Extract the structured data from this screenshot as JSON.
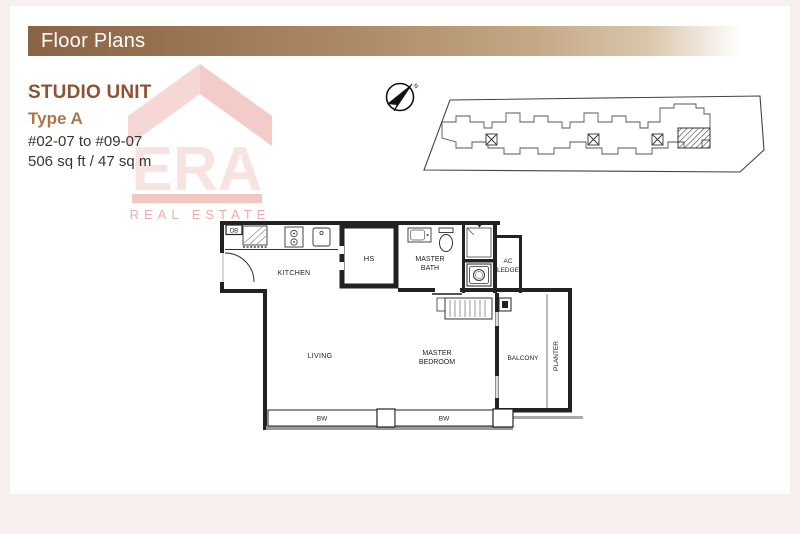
{
  "header": {
    "title": "Floor Plans"
  },
  "unit": {
    "name": "STUDIO UNIT",
    "type": "Type A",
    "range": "#02-07 to #09-07",
    "area": "506 sq ft / 47 sq m"
  },
  "watermark": {
    "brand": "ERA",
    "tagline": "REAL ESTATE"
  },
  "compass": {
    "north": "N"
  },
  "plan": {
    "labels": {
      "db": "DB",
      "kitchen": "KITCHEN",
      "hs": "HS",
      "master": "MASTER",
      "bath": "BATH",
      "ac": "AC",
      "ledge": "LEDGE",
      "living": "LIVING",
      "bedroom": "BEDROOM",
      "balcony": "BALCONY",
      "planter": "PLANTER",
      "bw": "BW"
    }
  },
  "colors": {
    "header_gradient_start": "#8a6345",
    "header_gradient_end": "#d9c5aa",
    "header_text": "#ffffff",
    "unit_name": "#8d5331",
    "unit_type": "#a9784a",
    "body_text": "#3a3632",
    "watermark_chevron": "#f7d7d5",
    "watermark_chevron_dark": "#f3cbc8",
    "watermark_bar": "#f3c6c2",
    "watermark_tagline": "#e9aeaa",
    "plan_line": "#222222",
    "page_edge": "#f8f0ee"
  }
}
